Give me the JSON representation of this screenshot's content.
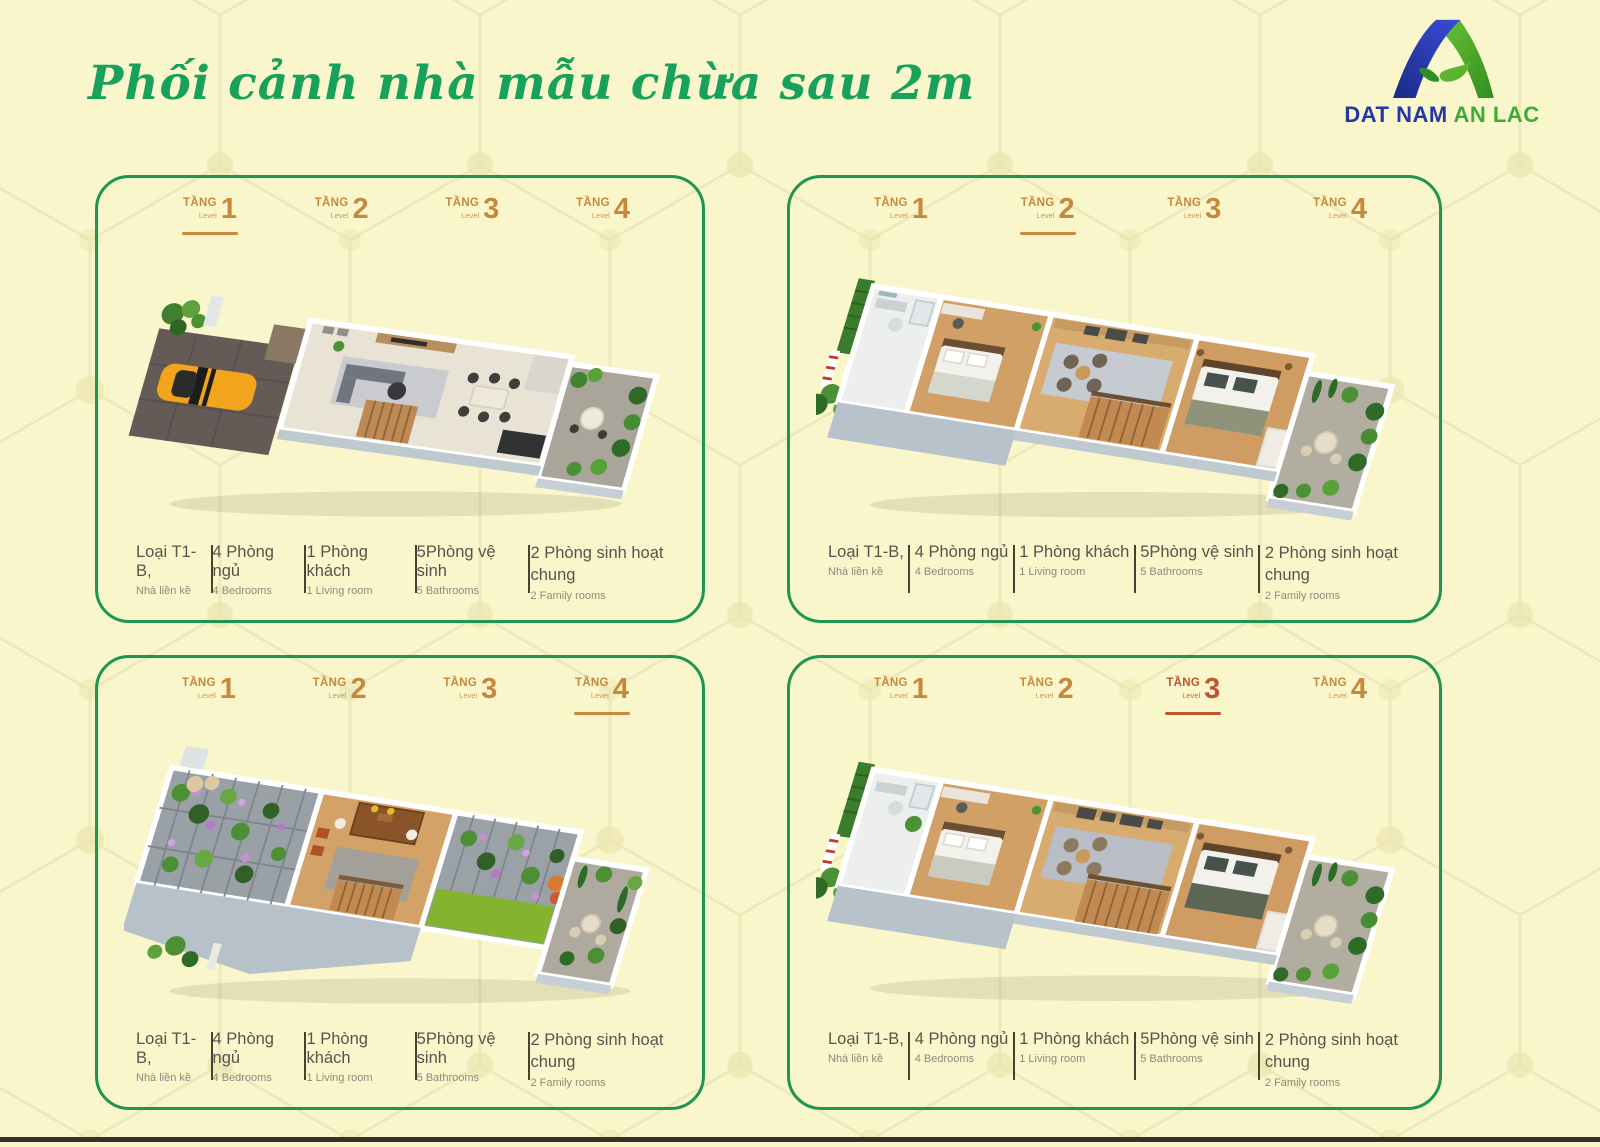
{
  "page": {
    "title": "Phối cảnh nhà mẫu chừa sau 2m",
    "colors": {
      "background": "#F9F6CB",
      "hex_pattern_line": "#ECE8BA",
      "title_green": "#18A15B",
      "panel_border_green": "#1F9552",
      "tab_orange": "#C8883C",
      "tab_active_red": "#BE5430",
      "info_text": "#57544B",
      "info_subtext": "#8E8A7D"
    }
  },
  "logo": {
    "mark": "mountain-a-with-leaf",
    "word_blue": "DAT NAM",
    "word_green": "AN LAC",
    "blue": "#2437A8",
    "green": "#3BAD35"
  },
  "panels": [
    {
      "id": "top-left",
      "floorplan": "level-1-ground-floor-garage-car-living-kitchen-rear-garden",
      "active_tab_index": 0,
      "tabs": [
        {
          "tang": "TẦNG",
          "level": "Level",
          "num": "1",
          "active": true
        },
        {
          "tang": "TẦNG",
          "level": "Level",
          "num": "2",
          "active": false
        },
        {
          "tang": "TẦNG",
          "level": "Level",
          "num": "3",
          "active": false
        },
        {
          "tang": "TẦNG",
          "level": "Level",
          "num": "4",
          "active": false
        }
      ],
      "info": [
        {
          "vi": "Loại T1-B,",
          "en": "Nhà liền kề"
        },
        {
          "vi": "4 Phòng ngủ",
          "en": "4 Bedrooms"
        },
        {
          "vi": "1 Phòng khách",
          "en": "1 Living room"
        },
        {
          "vi": "5Phòng vệ sinh",
          "en": "5 Bathrooms"
        },
        {
          "vi": "2 Phòng sinh hoạt chung",
          "en": "2 Family rooms"
        }
      ]
    },
    {
      "id": "top-right",
      "floorplan": "level-2-bathroom-bedrooms-family-area-stairs-terrace-garden",
      "active_tab_index": 1,
      "tabs": [
        {
          "tang": "TẦNG",
          "level": "Level",
          "num": "1",
          "active": false
        },
        {
          "tang": "TẦNG",
          "level": "Level",
          "num": "2",
          "active": true
        },
        {
          "tang": "TẦNG",
          "level": "Level",
          "num": "3",
          "active": false
        },
        {
          "tang": "TẦNG",
          "level": "Level",
          "num": "4",
          "active": false
        }
      ],
      "info": [
        {
          "vi": "Loại T1-B,",
          "en": "Nhà liền kề"
        },
        {
          "vi": "4 Phòng ngủ",
          "en": "4 Bedrooms"
        },
        {
          "vi": "1 Phòng khách",
          "en": "1 Living room"
        },
        {
          "vi": "5Phòng vệ sinh",
          "en": "5 Bathrooms"
        },
        {
          "vi": "2 Phòng sinh hoạt chung",
          "en": "2 Family rooms"
        }
      ]
    },
    {
      "id": "bottom-left",
      "floorplan": "level-4-rooftop-flower-pergolas-worship-room-lawn-terrace",
      "active_tab_index": 3,
      "tabs": [
        {
          "tang": "TẦNG",
          "level": "Level",
          "num": "1",
          "active": false
        },
        {
          "tang": "TẦNG",
          "level": "Level",
          "num": "2",
          "active": false
        },
        {
          "tang": "TẦNG",
          "level": "Level",
          "num": "3",
          "active": false
        },
        {
          "tang": "TẦNG",
          "level": "Level",
          "num": "4",
          "active": true
        }
      ],
      "info": [
        {
          "vi": "Loại T1-B,",
          "en": "Nhà liền kề"
        },
        {
          "vi": "4 Phòng ngủ",
          "en": "4 Bedrooms"
        },
        {
          "vi": "1 Phòng khách",
          "en": "1 Living room"
        },
        {
          "vi": "5Phòng vệ sinh",
          "en": "5 Bathrooms"
        },
        {
          "vi": "2 Phòng sinh hoạt chung",
          "en": "2 Family rooms"
        }
      ]
    },
    {
      "id": "bottom-right",
      "floorplan": "level-3-bedrooms-sitting-area-stairs-terrace-garden",
      "active_tab_index": 2,
      "tabs": [
        {
          "tang": "TẦNG",
          "level": "Level",
          "num": "1",
          "active": false
        },
        {
          "tang": "TẦNG",
          "level": "Level",
          "num": "2",
          "active": false
        },
        {
          "tang": "TẦNG",
          "level": "Level",
          "num": "3",
          "active": true
        },
        {
          "tang": "TẦNG",
          "level": "Level",
          "num": "4",
          "active": false
        }
      ],
      "info": [
        {
          "vi": "Loại T1-B,",
          "en": "Nhà liền kề"
        },
        {
          "vi": "4 Phòng ngủ",
          "en": "4 Bedrooms"
        },
        {
          "vi": "1 Phòng khách",
          "en": "1 Living room"
        },
        {
          "vi": "5Phòng vệ sinh",
          "en": "5 Bathrooms"
        },
        {
          "vi": "2 Phòng sinh hoạt chung",
          "en": "2 Family rooms"
        }
      ]
    }
  ]
}
